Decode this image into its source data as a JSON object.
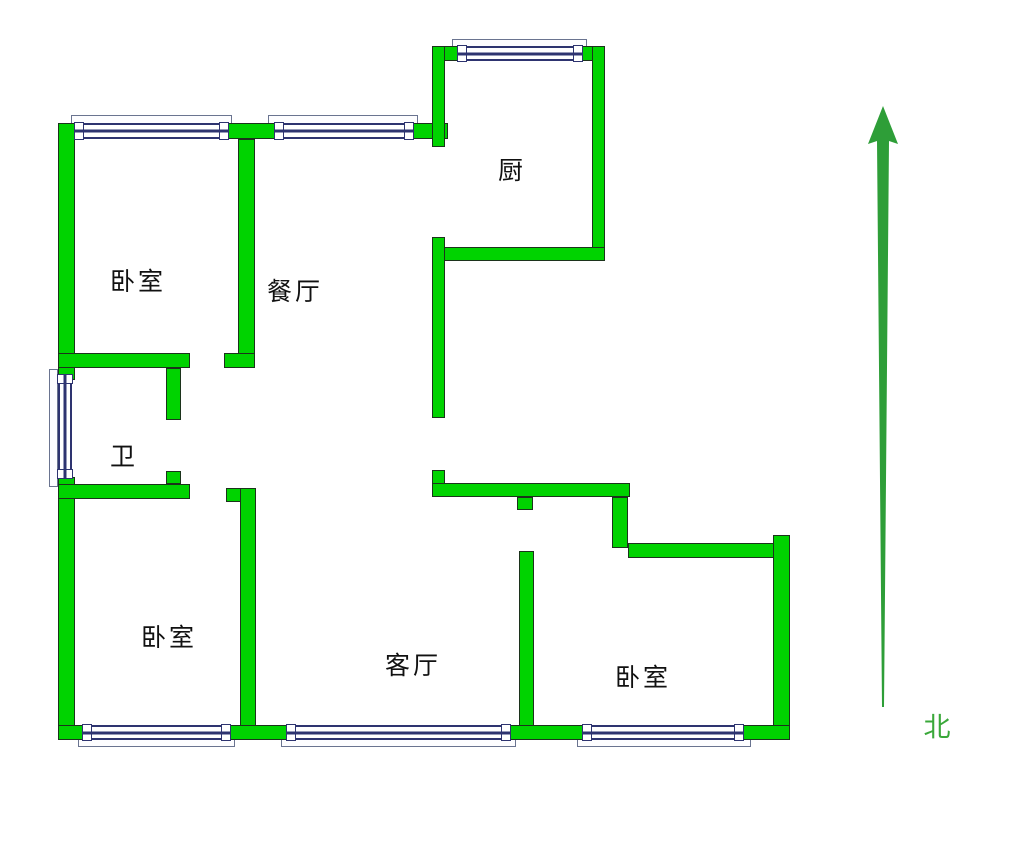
{
  "title": "apartment-floor-plan",
  "colors": {
    "bg": "#ffffff",
    "wall_fill": "#00d300",
    "wall_line": "#1c331c",
    "frame": "#2e3470",
    "sill_line": "#6a7490",
    "arrow": "#2e9e38",
    "north": "#3aa83a",
    "label": "#111111"
  },
  "rooms": [
    {
      "id": "kitchen",
      "label": "厨"
    },
    {
      "id": "bedroom-top-left",
      "label": "卧室"
    },
    {
      "id": "dining-room",
      "label": "餐厅"
    },
    {
      "id": "bathroom",
      "label": "卫"
    },
    {
      "id": "bedroom-bottom-left",
      "label": "卧室"
    },
    {
      "id": "living-room",
      "label": "客厅"
    },
    {
      "id": "bedroom-bottom-right",
      "label": "卧室"
    }
  ],
  "compass": {
    "label": "北",
    "direction": "up"
  }
}
